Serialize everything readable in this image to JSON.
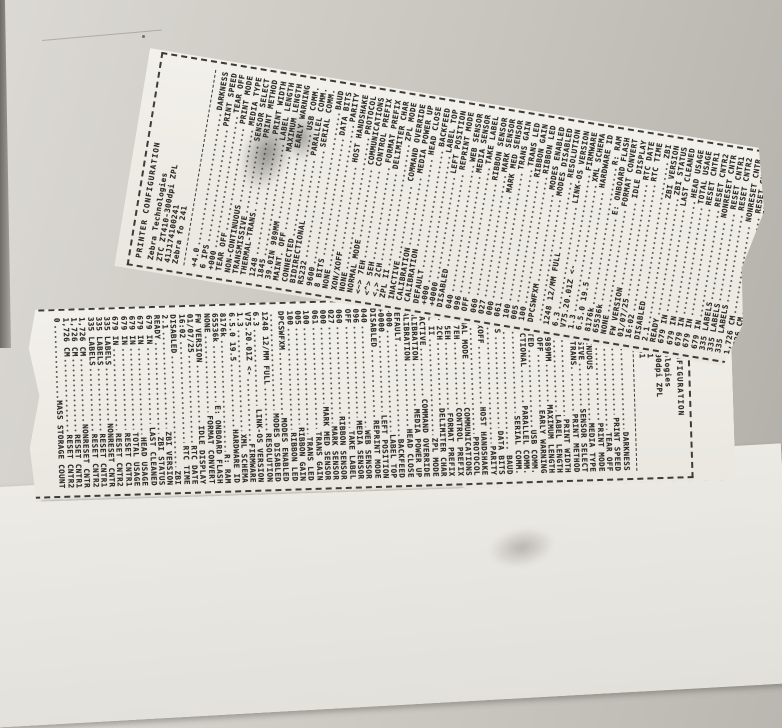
{
  "palette": {
    "paper": "#f0eee8",
    "ink": "#2e2c29",
    "background": "#c8c5bf",
    "backing_sheet": "#eae8e2"
  },
  "label": {
    "header": {
      "title": "PRINTER CONFIGURATION",
      "company": "Zebra Technologies",
      "model": "ZTC ZT410-300dpi ZPL",
      "serial": "41J174100241",
      "user_text": "Zebra fo 241"
    },
    "lines": [
      {
        "value": "+4.0",
        "name": "DARKNESS"
      },
      {
        "value": "6 IPS",
        "name": "PRINT SPEED"
      },
      {
        "value": "+000",
        "name": "TEAR OFF"
      },
      {
        "value": "TEAR OFF",
        "name": "PRINT MODE"
      },
      {
        "value": "NON-CONTINUOUS",
        "name": "MEDIA TYPE"
      },
      {
        "value": "TRANSMISSIVE",
        "name": "SENSOR SELECT"
      },
      {
        "value": "THERMAL-TRANS.",
        "name": "PRINT METHOD"
      },
      {
        "value": "1248",
        "name": "PRINT WIDTH"
      },
      {
        "value": "1845",
        "name": "LABEL LENGTH"
      },
      {
        "value": "39.0IN 989MM",
        "name": "MAXIMUM LENGTH"
      },
      {
        "value": "MAINT. OFF",
        "name": "EARLY WARNING"
      },
      {
        "value": "CONNECTED",
        "name": "USB COMM."
      },
      {
        "value": "BIDIRECTIONAL",
        "name": "PARALLEL COMM."
      },
      {
        "value": "RS232",
        "name": "SERIAL COMM."
      },
      {
        "value": "9600",
        "name": "BAUD"
      },
      {
        "value": "8 BITS",
        "name": "DATA BITS"
      },
      {
        "value": "NONE",
        "name": "PARITY"
      },
      {
        "value": "XON/XOFF",
        "name": "HOST HANDSHAKE"
      },
      {
        "value": "NONE",
        "name": "PROTOCOL"
      },
      {
        "value": "NORMAL MODE",
        "name": "COMMUNICATIONS"
      },
      {
        "value": "<~> 7EH",
        "name": "CONTROL PREFIX"
      },
      {
        "value": "<^> 5EH",
        "name": "FORMAT PREFIX"
      },
      {
        "value": "<,> 2CH",
        "name": "DELIMITER CHAR"
      },
      {
        "value": "ZPL II",
        "name": "ZPL MODE"
      },
      {
        "value": "INACTIVE",
        "name": "COMMAND OVERRIDE"
      },
      {
        "value": "CALIBRATION",
        "name": "MEDIA POWER UP"
      },
      {
        "value": "CALIBRATION",
        "name": "HEAD CLOSE"
      },
      {
        "value": "DEFAULT",
        "name": "BACKFEED"
      },
      {
        "value": "+000",
        "name": "LABEL TOP"
      },
      {
        "value": "+0000",
        "name": "LEFT POSITION"
      },
      {
        "value": "DISABLED",
        "name": "REPRINT MODE"
      },
      {
        "value": "040",
        "name": "WEB SENSOR"
      },
      {
        "value": "096",
        "name": "MEDIA SENSOR"
      },
      {
        "value": "OFF",
        "name": "TAKE LABEL"
      },
      {
        "value": "060",
        "name": "RIBBON SENSOR"
      },
      {
        "value": "027",
        "name": "MARK SENSOR"
      },
      {
        "value": "000",
        "name": "MARK MED SENSOR"
      },
      {
        "value": "061",
        "name": "TRANS GAIN"
      },
      {
        "value": "100",
        "name": "TRANS LED"
      },
      {
        "value": "005",
        "name": "RIBBON GAIN"
      },
      {
        "value": "100",
        "name": "RIBBON LED"
      },
      {
        "value": "DPCSWFXM",
        "name": "MODES ENABLED"
      },
      {
        "value": "",
        "name": "MODES DISABLED"
      },
      {
        "value": "1248 12/MM FULL",
        "name": "RESOLUTION"
      },
      {
        "value": "6.3",
        "name": "LINK-OS VERSION"
      },
      {
        "value": "V75.20.01Z <-",
        "name": "FIRMWARE"
      },
      {
        "value": "1.3",
        "name": "XML SCHEMA"
      },
      {
        "value": "6.5.0 19.5",
        "name": "HARDWARE ID"
      },
      {
        "value": "8176k",
        "name": "R: RAM"
      },
      {
        "value": "65536k",
        "name": "E: ONBOARD FLASH"
      },
      {
        "value": "NONE",
        "name": "FORMAT CONVERT"
      },
      {
        "value": "FW VERSION",
        "name": "IDLE DISPLAY"
      },
      {
        "value": "01/07/25",
        "name": "RTC DATE"
      },
      {
        "value": "16:02",
        "name": "RTC TIME"
      },
      {
        "value": "DISABLED",
        "name": "ZBI"
      },
      {
        "value": "2.1",
        "name": "ZBI VERSION"
      },
      {
        "value": "READY",
        "name": "ZBI STATUS"
      },
      {
        "value": "679 IN",
        "name": "LAST CLEANED"
      },
      {
        "value": "679 IN",
        "name": "HEAD USAGE"
      },
      {
        "value": "679 IN",
        "name": "TOTAL USAGE"
      },
      {
        "value": "679 IN",
        "name": "RESET CNTR1"
      },
      {
        "value": "679 IN",
        "name": "RESET CNTR2"
      },
      {
        "value": "335 LABELS",
        "name": "NONRESET CNTR"
      },
      {
        "value": "335 LABELS",
        "name": "RESET CNTR1"
      },
      {
        "value": "335 LABELS",
        "name": "RESET CNTR2"
      },
      {
        "value": "1,726 CM",
        "name": "NONRESET CNTR"
      },
      {
        "value": "1,726 CM",
        "name": "RESET CNTR1"
      },
      {
        "value": "1,726 CM",
        "name": "RESET CNTR2"
      },
      {
        "value": "0",
        "name": "MASS STORAGE COUNT"
      }
    ]
  }
}
